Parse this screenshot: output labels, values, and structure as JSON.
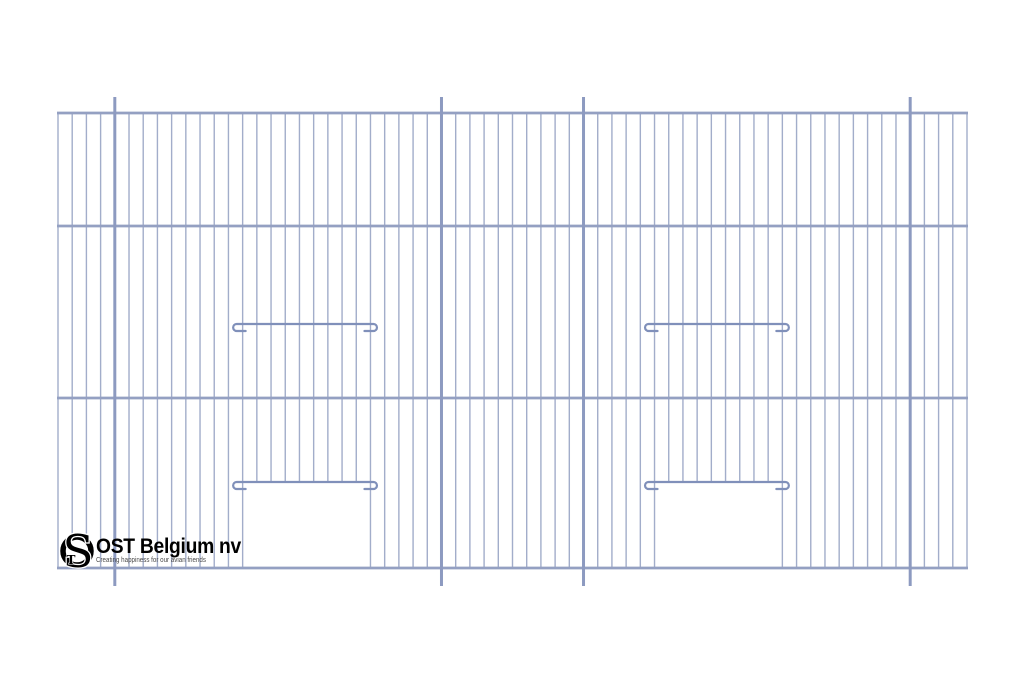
{
  "company": {
    "name": "OST Belgium nv",
    "tagline": "Creating happiness for our avian friends",
    "monogram_s": "S",
    "monogram_t": "T"
  },
  "colors": {
    "background": "#ffffff",
    "wire": "#a2adca",
    "post": "#8d9ac0",
    "bar": "#94a0c2",
    "rail": "#8090ba",
    "logo_ink": "#000000",
    "tagline_ink": "#4a4a4a"
  },
  "drawing": {
    "type": "bird-cage-front-panel",
    "frame": {
      "left": 58,
      "right": 967,
      "top": 113,
      "bottom": 568
    },
    "horizontal_bars_y": [
      113,
      226,
      398,
      568
    ],
    "wire_count": 65,
    "post_indices": [
      4,
      27,
      37,
      60
    ],
    "post_overhang": {
      "top": 16,
      "bottom": 18
    },
    "doors": [
      {
        "from_wire": 13,
        "to_wire": 22,
        "rail_y": 482
      },
      {
        "from_wire": 42,
        "to_wire": 51,
        "rail_y": 482
      }
    ],
    "perch_rails": [
      {
        "from_wire": 13,
        "to_wire": 22,
        "rail_y": 324
      },
      {
        "from_wire": 42,
        "to_wire": 51,
        "rail_y": 324
      }
    ],
    "rail_end_overhang": {
      "left": 11,
      "right": 8
    },
    "rail_hook": {
      "radius": 3.5,
      "drop": 7,
      "stub": 9
    }
  }
}
